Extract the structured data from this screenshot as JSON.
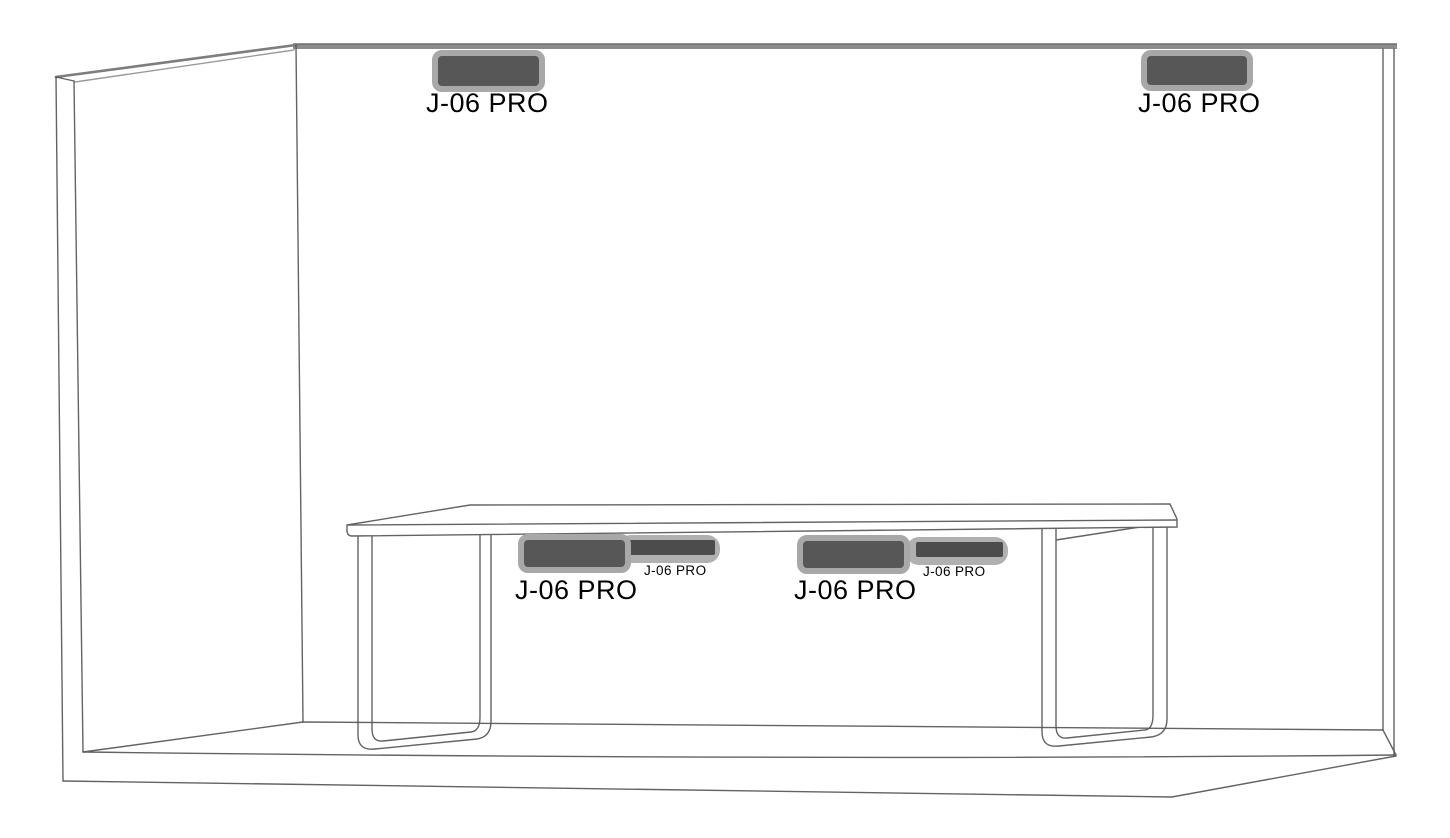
{
  "figure": {
    "devices": {
      "wall_left": {
        "label": "J-06 PRO"
      },
      "wall_right": {
        "label": "J-06 PRO"
      },
      "table_left_main": {
        "label": "J-06 PRO"
      },
      "table_left_bar": {
        "label": "J-06 PRO"
      },
      "table_right_main": {
        "label": "J-06 PRO"
      },
      "table_right_bar": {
        "label": "J-06 PRO"
      }
    },
    "colors": {
      "background": "#ffffff",
      "outline": "#565656",
      "wall_band": "#8c8c8c",
      "wall_band_edge": "#6e6e6e",
      "device_body": "#575757",
      "device_border": "#a8a8a8",
      "bar_body": "#4c4c4c",
      "bar_border": "#b0b0b0",
      "label": "#000000"
    }
  }
}
